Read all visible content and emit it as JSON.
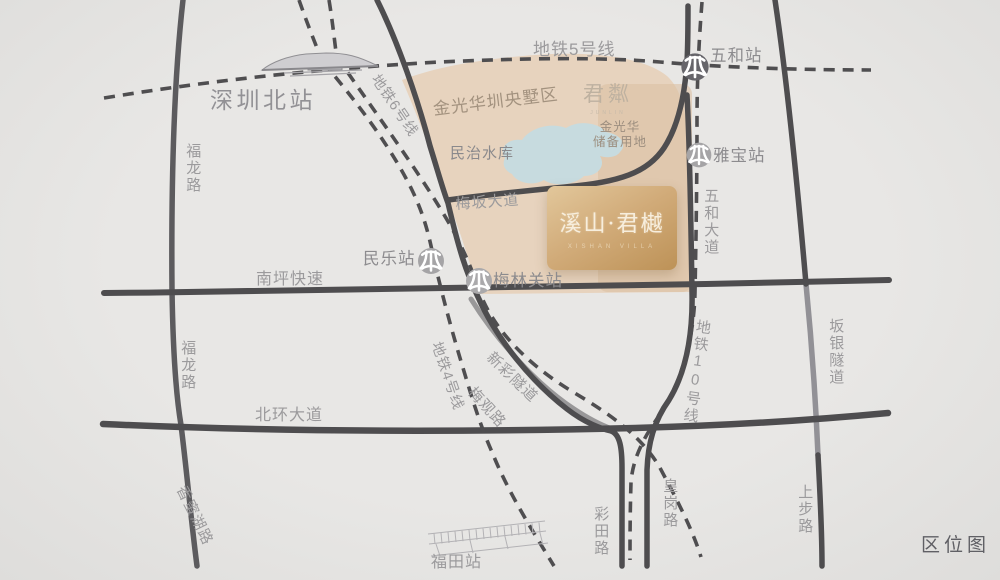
{
  "map": {
    "badge": "区位图",
    "project": {
      "name": "溪山·君樾",
      "subtitle": "XISHAN VILLA"
    },
    "labels": {
      "metro5": "地铁5号线",
      "metro6": "地铁6号线",
      "metro4": "地铁4号线",
      "metro10": "地铁10号线",
      "shenzhen_north": "深圳北站",
      "wuhe_station": "五和站",
      "yabao_station": "雅宝站",
      "minle_station": "民乐站",
      "meilinguan_station": "梅林关站",
      "futian_station": "福田站",
      "fulong_road_upper": "福龙路",
      "fulong_road_lower": "福龙路",
      "nanping_expressway": "南坪快速",
      "beihuan_avenue": "北环大道",
      "meiban_avenue": "梅坂大道",
      "wuhe_avenue": "五和大道",
      "meiguan_road": "梅观路",
      "xincai_tunnel": "新彩隧道",
      "banyin_tunnel": "坂银隧道",
      "xiangmihu_road": "香蜜湖路",
      "caitian_road": "彩田路",
      "huanggang_road": "皇岗路",
      "shangbu_road": "上步路",
      "minzhi_reservoir": "民治水库",
      "jgh_district": "金光华圳央墅区",
      "jgh_reserve_line1": "金光华",
      "jgh_reserve_line2": "储备用地",
      "junlin_logo": "君粼",
      "junlin_sub": "JUNLIN"
    },
    "colors": {
      "background": "#e6e5e3",
      "beige_area": "#e7d3be",
      "tan_band": "#dcc2a4",
      "lake": "#c7dbdf",
      "card_gold_light": "#e2c79b",
      "card_gold_dark": "#bd9257",
      "road_dark": "#4e4d4f",
      "road_tunnel_gray": "#97969a",
      "metro_dash": "#4f4e50",
      "label_gray": "#9b9a9c",
      "station_label_gray": "#8c8b8e",
      "badge_gray": "#606065"
    }
  }
}
